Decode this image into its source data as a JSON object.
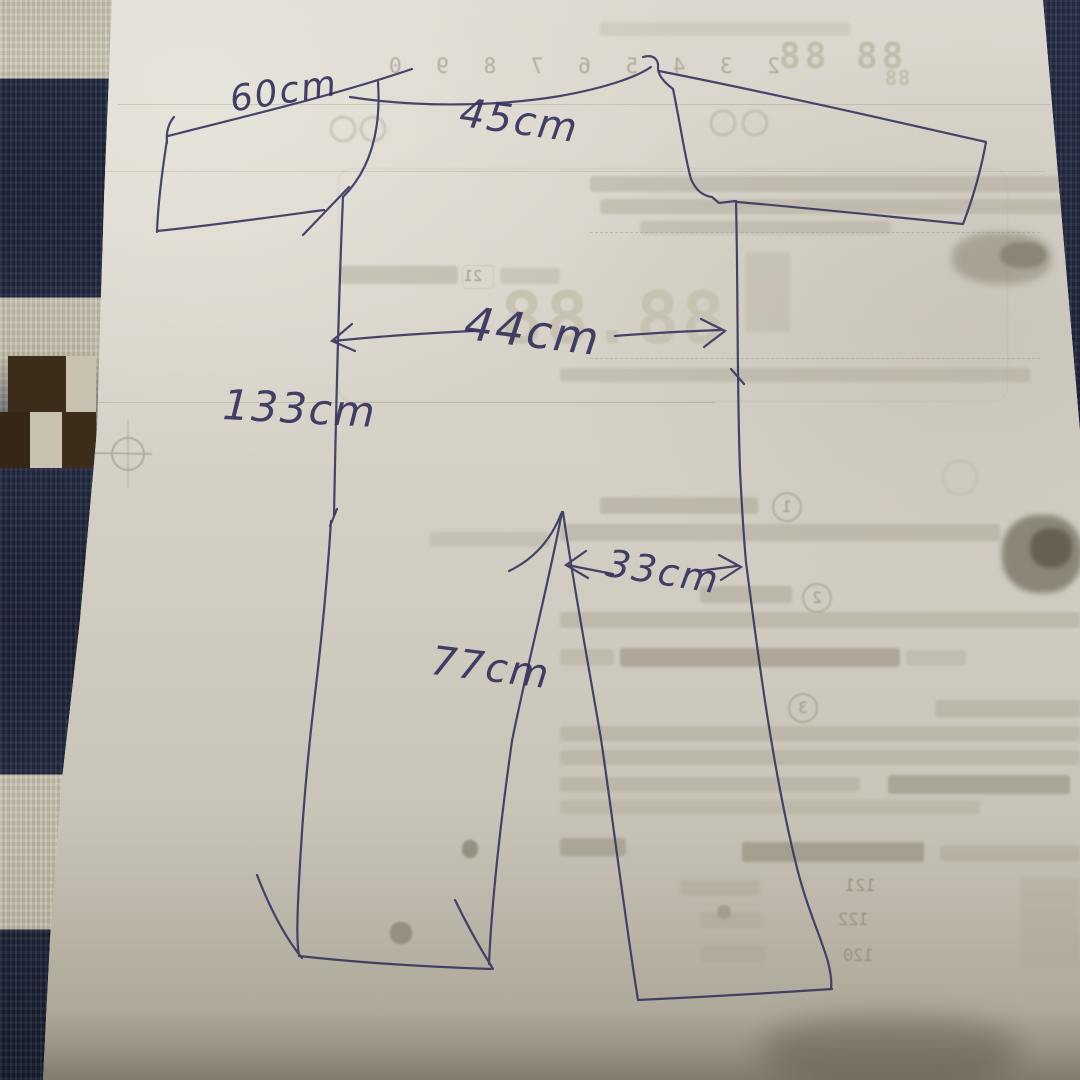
{
  "scene": {
    "description": "Hand-drawn clothing measurement sketch (jumpsuit) in pen on the back of a printed Japanese instruction sheet, photographed on a navy and cream patterned carpet"
  },
  "measurements": {
    "sleeve_length": "60cm",
    "shoulder_width": "45cm",
    "chest_width": "44cm",
    "total_length": "133cm",
    "leg_width": "33cm",
    "inseam": "77cm"
  },
  "print_through": {
    "segment_display_top": "88 88",
    "segment_display_top_small": "88",
    "segment_display_large": "88.88",
    "digit_row": "2 3 4 5 6 7 8 9 0",
    "boxed_value": "21",
    "step_numbers": [
      "1",
      "2",
      "3"
    ],
    "size_rows": [
      "121",
      "122",
      "120"
    ]
  },
  "colors": {
    "ink": "#35315b",
    "paper": "#d5d0c6",
    "carpet_navy": "#232a40",
    "carpet_cream": "#cdc6b4",
    "carpet_brown": "#3c2c1a"
  }
}
